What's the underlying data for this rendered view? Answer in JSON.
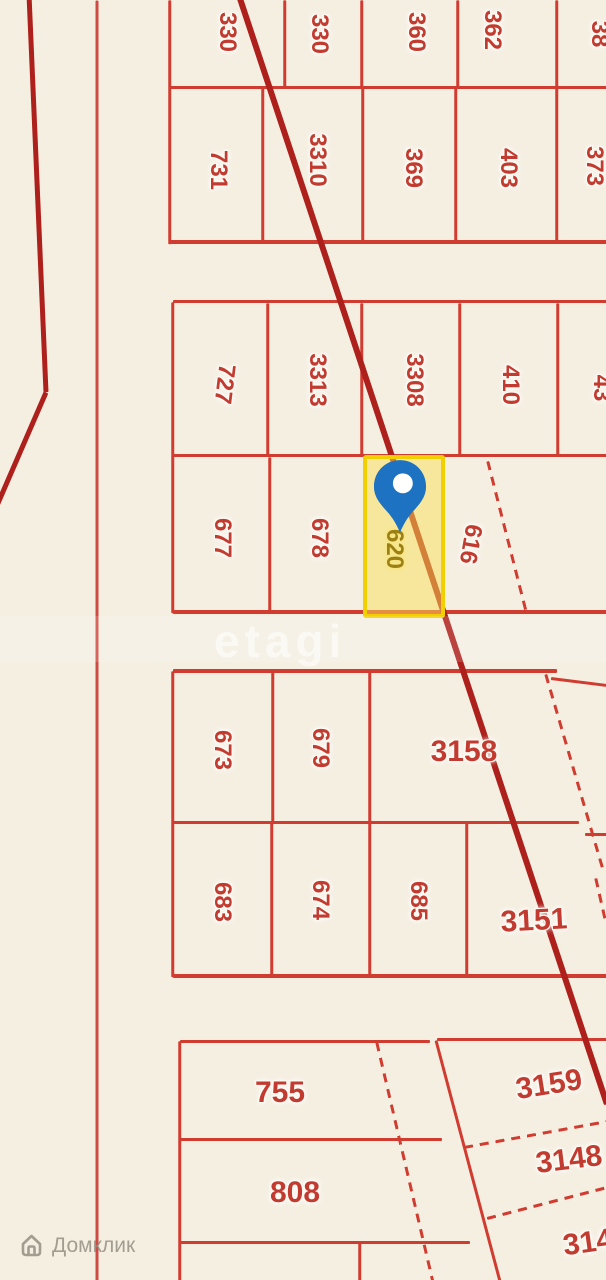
{
  "map": {
    "background": "#f5efe2",
    "colors": {
      "line": "#d13c31",
      "thick_line": "#ad201c",
      "road_line": "#cd4b40",
      "label": "#c23b31",
      "selected_border": "#f2cf00",
      "selected_fill": "rgba(250,224,85,0.5)",
      "selected_label": "#9d8013",
      "pin_blue": "#1d72c2"
    },
    "watermark_center": "etagi",
    "watermark_brand": "Домклик",
    "selected_plot": {
      "number": "620",
      "x": 363,
      "y": 455,
      "w": 82,
      "h": 163
    },
    "pin": {
      "x": 373,
      "y": 459,
      "w": 54,
      "h": 78
    },
    "lines": [
      {
        "x1": 170,
        "y1": 87.5,
        "x2": 607,
        "y2": 87.5,
        "w": 3.5
      },
      {
        "x1": 170,
        "y1": 242,
        "x2": 607,
        "y2": 242,
        "w": 3.5
      },
      {
        "x1": 170,
        "y1": 0,
        "x2": 170,
        "y2": 244,
        "w": 2.5
      },
      {
        "x1": 285,
        "y1": 0,
        "x2": 285,
        "y2": 88,
        "w": 2.5
      },
      {
        "x1": 362,
        "y1": 0,
        "x2": 362,
        "y2": 88,
        "w": 2.5
      },
      {
        "x1": 458,
        "y1": 0,
        "x2": 458,
        "y2": 88,
        "w": 2.5
      },
      {
        "x1": 557,
        "y1": 0,
        "x2": 557,
        "y2": 88,
        "w": 2.5
      },
      {
        "x1": 263,
        "y1": 88,
        "x2": 263,
        "y2": 243,
        "w": 2.5
      },
      {
        "x1": 363,
        "y1": 88,
        "x2": 363,
        "y2": 243,
        "w": 2.5
      },
      {
        "x1": 456,
        "y1": 88,
        "x2": 456,
        "y2": 243,
        "w": 2.5
      },
      {
        "x1": 557,
        "y1": 88,
        "x2": 557,
        "y2": 243,
        "w": 2.5
      },
      {
        "x1": 173,
        "y1": 301.5,
        "x2": 607,
        "y2": 301.5,
        "w": 3.5
      },
      {
        "x1": 173,
        "y1": 455.5,
        "x2": 607,
        "y2": 455.5,
        "w": 3.5
      },
      {
        "x1": 173,
        "y1": 612,
        "x2": 607,
        "y2": 612,
        "w": 3.5
      },
      {
        "x1": 173,
        "y1": 302,
        "x2": 173,
        "y2": 613,
        "w": 2.5
      },
      {
        "x1": 268,
        "y1": 303,
        "x2": 268,
        "y2": 456,
        "w": 2.5
      },
      {
        "x1": 362,
        "y1": 303,
        "x2": 362,
        "y2": 456,
        "w": 2.5
      },
      {
        "x1": 460,
        "y1": 303,
        "x2": 460,
        "y2": 456,
        "w": 2.5
      },
      {
        "x1": 558,
        "y1": 303,
        "x2": 558,
        "y2": 456,
        "w": 2.5
      },
      {
        "x1": 270,
        "y1": 457,
        "x2": 270,
        "y2": 612,
        "w": 2.5
      },
      {
        "x1": 365,
        "y1": 457,
        "x2": 365,
        "y2": 612,
        "w": 2.5
      },
      {
        "x1": 173,
        "y1": 671,
        "x2": 557,
        "y2": 671,
        "w": 3.5
      },
      {
        "x1": 551,
        "y1": 678,
        "x2": 607,
        "y2": 685,
        "w": 3
      },
      {
        "x1": 173,
        "y1": 822,
        "x2": 579,
        "y2": 822,
        "w": 3
      },
      {
        "x1": 585,
        "y1": 834,
        "x2": 607,
        "y2": 834,
        "w": 3
      },
      {
        "x1": 173,
        "y1": 976,
        "x2": 607,
        "y2": 976,
        "w": 3.5
      },
      {
        "x1": 173,
        "y1": 671,
        "x2": 173,
        "y2": 977,
        "w": 2.5
      },
      {
        "x1": 273,
        "y1": 672,
        "x2": 273,
        "y2": 822,
        "w": 2.5
      },
      {
        "x1": 370,
        "y1": 672,
        "x2": 370,
        "y2": 822,
        "w": 2.5
      },
      {
        "x1": 272,
        "y1": 822,
        "x2": 272,
        "y2": 976,
        "w": 2.5
      },
      {
        "x1": 370,
        "y1": 822,
        "x2": 370,
        "y2": 976,
        "w": 2.5
      },
      {
        "x1": 467,
        "y1": 822,
        "x2": 467,
        "y2": 976,
        "w": 2.5
      },
      {
        "x1": 180,
        "y1": 1041,
        "x2": 430,
        "y2": 1041,
        "w": 3
      },
      {
        "x1": 180,
        "y1": 1139,
        "x2": 442,
        "y2": 1139,
        "w": 3
      },
      {
        "x1": 180,
        "y1": 1242,
        "x2": 470,
        "y2": 1242,
        "w": 3
      },
      {
        "x1": 180,
        "y1": 1041,
        "x2": 180,
        "y2": 1281,
        "w": 2.5
      },
      {
        "x1": 360,
        "y1": 1242,
        "x2": 360,
        "y2": 1281,
        "w": 2.5
      },
      {
        "x1": 437,
        "y1": 1039,
        "x2": 607,
        "y2": 1039,
        "w": 3
      },
      {
        "x1": 436,
        "y1": 1040,
        "x2": 500,
        "y2": 1281,
        "w": 3
      },
      {
        "x1": 488,
        "y1": 461,
        "x2": 526,
        "y2": 610,
        "w": 2.5,
        "dashed": true
      },
      {
        "x1": 546,
        "y1": 674,
        "x2": 604,
        "y2": 872,
        "w": 2.5,
        "dashed": true
      },
      {
        "x1": 596,
        "y1": 878,
        "x2": 606,
        "y2": 922,
        "w": 2.5,
        "dashed": true
      },
      {
        "x1": 377,
        "y1": 1042,
        "x2": 433,
        "y2": 1281,
        "w": 2.5,
        "dashed": true
      },
      {
        "x1": 464,
        "y1": 1147,
        "x2": 607,
        "y2": 1121,
        "w": 2.5,
        "dashed": true
      },
      {
        "x1": 487,
        "y1": 1218,
        "x2": 607,
        "y2": 1187,
        "w": 2.5,
        "dashed": true
      },
      {
        "x1": 97,
        "y1": 0,
        "x2": 97,
        "y2": 1281,
        "w": 3,
        "color": "#cd4b40",
        "name": "road-line"
      },
      {
        "x1": 29,
        "y1": -6,
        "x2": 46,
        "y2": 392,
        "w": 5,
        "color": "#ad201c",
        "name": "powerline-left"
      },
      {
        "x1": 46,
        "y1": 392,
        "x2": -3,
        "y2": 505,
        "w": 5,
        "color": "#ad201c",
        "name": "powerline-left"
      },
      {
        "x1": 238,
        "y1": -8,
        "x2": 607,
        "y2": 1104,
        "w": 5.5,
        "color": "#ad201c",
        "name": "powerline-main"
      }
    ],
    "labels": [
      {
        "text": "330",
        "x": 227,
        "y": 32,
        "rot": 90
      },
      {
        "text": "330",
        "x": 319,
        "y": 34,
        "rot": 90
      },
      {
        "text": "360",
        "x": 416,
        "y": 32,
        "rot": 90
      },
      {
        "text": "362",
        "x": 492,
        "y": 30,
        "rot": 90
      },
      {
        "text": "38",
        "x": 599,
        "y": 34,
        "rot": 90
      },
      {
        "text": "731",
        "x": 218,
        "y": 170,
        "rot": 90
      },
      {
        "text": "3310",
        "x": 317,
        "y": 160,
        "rot": 90
      },
      {
        "text": "369",
        "x": 413,
        "y": 168,
        "rot": 90
      },
      {
        "text": "403",
        "x": 508,
        "y": 168,
        "rot": 90
      },
      {
        "text": "373",
        "x": 594,
        "y": 166,
        "rot": 90
      },
      {
        "text": "727",
        "x": 224,
        "y": 384,
        "rot": 97
      },
      {
        "text": "3313",
        "x": 317,
        "y": 380,
        "rot": 90
      },
      {
        "text": "3308",
        "x": 414,
        "y": 380,
        "rot": 90
      },
      {
        "text": "410",
        "x": 510,
        "y": 385,
        "rot": 90
      },
      {
        "text": "43",
        "x": 601,
        "y": 388,
        "rot": 90
      },
      {
        "text": "677",
        "x": 222,
        "y": 538,
        "rot": 90
      },
      {
        "text": "678",
        "x": 319,
        "y": 538,
        "rot": 90
      },
      {
        "text": "620",
        "x": 394,
        "y": 549,
        "rot": 90,
        "cls": "selected"
      },
      {
        "text": "616",
        "x": 470,
        "y": 544,
        "rot": 100
      },
      {
        "text": "673",
        "x": 222,
        "y": 750,
        "rot": 90
      },
      {
        "text": "679",
        "x": 320,
        "y": 748,
        "rot": 90
      },
      {
        "text": "3158",
        "x": 464,
        "y": 752,
        "rot": 0,
        "size": 30
      },
      {
        "text": "683",
        "x": 222,
        "y": 902,
        "rot": 90
      },
      {
        "text": "674",
        "x": 320,
        "y": 900,
        "rot": 90
      },
      {
        "text": "685",
        "x": 418,
        "y": 901,
        "rot": 90
      },
      {
        "text": "3151",
        "x": 534,
        "y": 921,
        "rot": -3,
        "size": 30
      },
      {
        "text": "755",
        "x": 280,
        "y": 1093,
        "rot": 0,
        "size": 30
      },
      {
        "text": "808",
        "x": 295,
        "y": 1193,
        "rot": 0,
        "size": 30
      },
      {
        "text": "3159",
        "x": 549,
        "y": 1085,
        "rot": -9,
        "size": 30
      },
      {
        "text": "3148",
        "x": 569,
        "y": 1160,
        "rot": -7,
        "size": 30
      },
      {
        "text": "314",
        "x": 588,
        "y": 1243,
        "rot": -8,
        "size": 30
      }
    ]
  }
}
